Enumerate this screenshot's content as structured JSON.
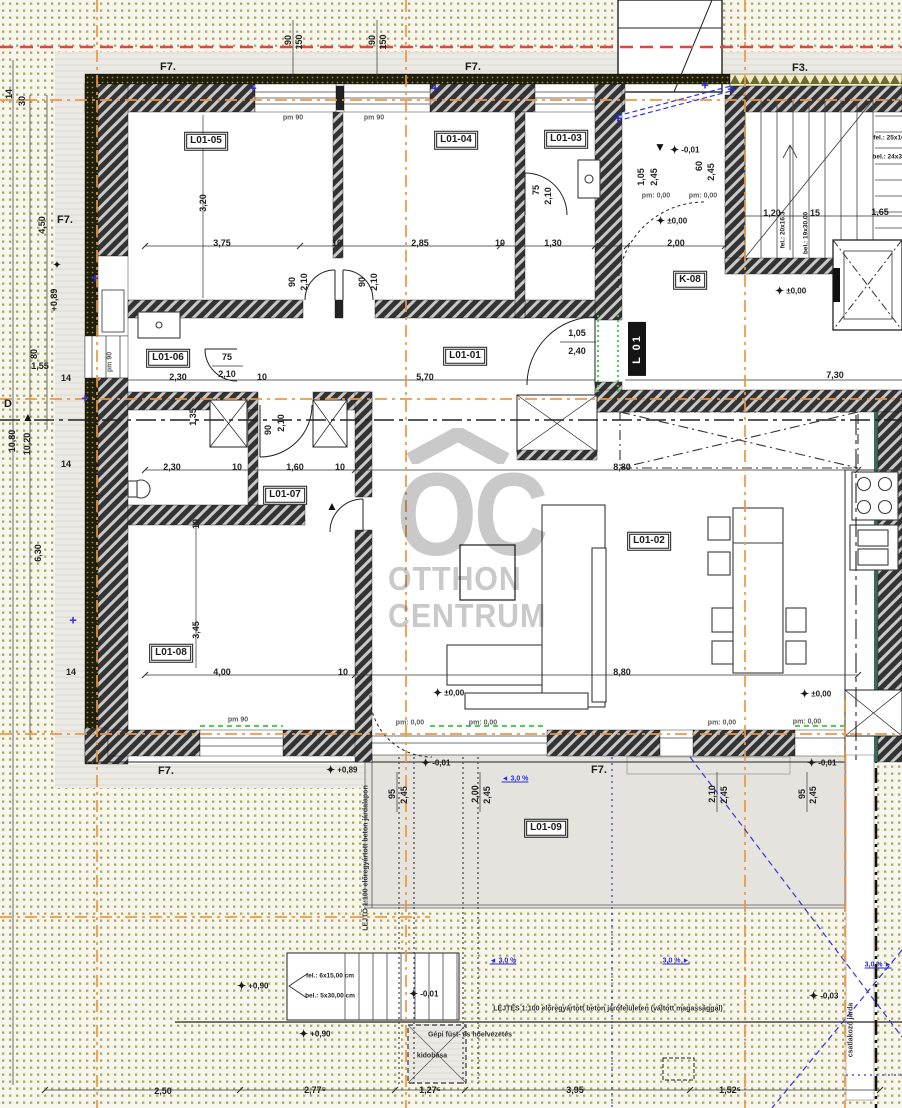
{
  "colors": {
    "paper": "#f8f6ec",
    "dot": "#a6a963",
    "apron": "#eae9e4",
    "terrace": "#e4e3de",
    "wall_dark": "#333333",
    "wall_stripe": "#c9c9c9",
    "insulation": "#1f1d0c",
    "accent_orange": "#f0953f",
    "accent_red": "#e04545",
    "accent_blue": "#3333e8",
    "accent_green": "#35cc35",
    "watermark": "#c6c6c6",
    "yellow_insulation": "#f0ebc4"
  },
  "watermark": {
    "logo": "OC",
    "line1": "OTTHON",
    "line2": "CENTRUM"
  },
  "texts": {
    "room_labels": [
      {
        "t": "L01-05",
        "x": 206,
        "y": 141
      },
      {
        "t": "L01-04",
        "x": 456,
        "y": 140
      },
      {
        "t": "L01-03",
        "x": 566,
        "y": 139
      },
      {
        "t": "L01-01",
        "x": 465,
        "y": 356
      },
      {
        "t": "L01-06",
        "x": 168,
        "y": 358
      },
      {
        "t": "L01-07",
        "x": 285,
        "y": 495
      },
      {
        "t": "L01-02",
        "x": 649,
        "y": 541
      },
      {
        "t": "L01-08",
        "x": 171,
        "y": 653
      },
      {
        "t": "L01-09",
        "x": 546,
        "y": 828
      },
      {
        "t": "K-08",
        "x": 690,
        "y": 280
      }
    ],
    "signs": [
      {
        "t": "L 01",
        "x": 637,
        "y": 349
      }
    ],
    "f_labels": [
      {
        "t": "F7.",
        "x": 168,
        "y": 67
      },
      {
        "t": "F7.",
        "x": 473,
        "y": 67
      },
      {
        "t": "F3.",
        "x": 800,
        "y": 68
      },
      {
        "t": "F7.",
        "x": 65,
        "y": 220
      },
      {
        "t": "F7.",
        "x": 166,
        "y": 771
      },
      {
        "t": "F7.",
        "x": 599,
        "y": 770
      },
      {
        "t": "D",
        "x": 8,
        "y": 404
      }
    ],
    "dims": [
      {
        "t": "3,75",
        "x": 222,
        "y": 243
      },
      {
        "t": "10",
        "x": 337,
        "y": 243
      },
      {
        "t": "2,85",
        "x": 420,
        "y": 243
      },
      {
        "t": "10",
        "x": 500,
        "y": 243
      },
      {
        "t": "1,30",
        "x": 553,
        "y": 243
      },
      {
        "t": "2,00",
        "x": 676,
        "y": 243
      },
      {
        "t": "2,30",
        "x": 178,
        "y": 377
      },
      {
        "t": "10",
        "x": 262,
        "y": 377
      },
      {
        "t": "5,70",
        "x": 425,
        "y": 377
      },
      {
        "t": "7,30",
        "x": 835,
        "y": 375
      },
      {
        "t": "75",
        "x": 227,
        "y": 357
      },
      {
        "t": "2,10",
        "x": 227,
        "y": 374
      },
      {
        "t": "2,30",
        "x": 172,
        "y": 467
      },
      {
        "t": "10",
        "x": 237,
        "y": 467
      },
      {
        "t": "1,60",
        "x": 295,
        "y": 467
      },
      {
        "t": "10",
        "x": 340,
        "y": 467
      },
      {
        "t": "8,80",
        "x": 622,
        "y": 467
      },
      {
        "t": "4,00",
        "x": 222,
        "y": 672
      },
      {
        "t": "10",
        "x": 343,
        "y": 672
      },
      {
        "t": "8,80",
        "x": 622,
        "y": 672
      },
      {
        "t": "1,20",
        "x": 772,
        "y": 213
      },
      {
        "t": "15",
        "x": 815,
        "y": 213
      },
      {
        "t": "1,65",
        "x": 880,
        "y": 212
      },
      {
        "t": "1,05",
        "x": 577,
        "y": 333
      },
      {
        "t": "2,40",
        "x": 577,
        "y": 351
      },
      {
        "t": "2,50",
        "x": 163,
        "y": 1091
      },
      {
        "t": "2,77⁵",
        "x": 315,
        "y": 1090
      },
      {
        "t": "1,27⁵",
        "x": 430,
        "y": 1090
      },
      {
        "t": "3,95",
        "x": 575,
        "y": 1090
      },
      {
        "t": "1,52⁵",
        "x": 730,
        "y": 1090
      },
      {
        "t": "1,55",
        "x": 40,
        "y": 366
      },
      {
        "t": "14",
        "x": 66,
        "y": 378
      },
      {
        "t": "14",
        "x": 66,
        "y": 464
      },
      {
        "t": "14",
        "x": 71,
        "y": 672
      },
      {
        "t": "3,20",
        "x": 203,
        "y": 203,
        "r": 1
      },
      {
        "t": "1,35",
        "x": 193,
        "y": 417,
        "r": 1
      },
      {
        "t": "3,45",
        "x": 196,
        "y": 630,
        "r": 1
      },
      {
        "t": "10",
        "x": 196,
        "y": 524,
        "r": 1
      },
      {
        "t": "90",
        "x": 292,
        "y": 282,
        "r": 1
      },
      {
        "t": "2,10",
        "x": 304,
        "y": 282,
        "r": 1
      },
      {
        "t": "90",
        "x": 362,
        "y": 282,
        "r": 1
      },
      {
        "t": "2,10",
        "x": 374,
        "y": 282,
        "r": 1
      },
      {
        "t": "75",
        "x": 536,
        "y": 190,
        "r": 1
      },
      {
        "t": "2,10",
        "x": 548,
        "y": 196,
        "r": 1
      },
      {
        "t": "90",
        "x": 268,
        "y": 430,
        "r": 1
      },
      {
        "t": "2,10",
        "x": 281,
        "y": 423,
        "r": 1
      },
      {
        "t": "1,05",
        "x": 641,
        "y": 177,
        "r": 1
      },
      {
        "t": "2,45",
        "x": 654,
        "y": 177,
        "r": 1
      },
      {
        "t": "60",
        "x": 699,
        "y": 166,
        "r": 1
      },
      {
        "t": "2,45",
        "x": 711,
        "y": 172,
        "r": 1
      },
      {
        "t": "95",
        "x": 392,
        "y": 794,
        "r": 1
      },
      {
        "t": "2,45",
        "x": 404,
        "y": 795,
        "r": 1
      },
      {
        "t": "2,00",
        "x": 475,
        "y": 794,
        "r": 1
      },
      {
        "t": "2,45",
        "x": 487,
        "y": 795,
        "r": 1
      },
      {
        "t": "2,10",
        "x": 712,
        "y": 794,
        "r": 1
      },
      {
        "t": "2,45",
        "x": 724,
        "y": 795,
        "r": 1
      },
      {
        "t": "95",
        "x": 802,
        "y": 794,
        "r": 1
      },
      {
        "t": "2,45",
        "x": 813,
        "y": 795,
        "r": 1
      },
      {
        "t": "4,50",
        "x": 42,
        "y": 225,
        "r": 1
      },
      {
        "t": "+0,89",
        "x": 54,
        "y": 300,
        "r": 1
      },
      {
        "t": "80",
        "x": 34,
        "y": 354,
        "r": 1
      },
      {
        "t": "10,80",
        "x": 12,
        "y": 441,
        "r": 1
      },
      {
        "t": "10,20",
        "x": 27,
        "y": 444,
        "r": 1
      },
      {
        "t": "6,30",
        "x": 38,
        "y": 553,
        "r": 1
      },
      {
        "t": "30",
        "x": 22,
        "y": 101,
        "r": 1
      },
      {
        "t": "14",
        "x": 9,
        "y": 94,
        "r": 1
      },
      {
        "t": "90",
        "x": 288,
        "y": 40,
        "r": 1
      },
      {
        "t": "150",
        "x": 299,
        "y": 42,
        "r": 1
      },
      {
        "t": "90",
        "x": 372,
        "y": 40,
        "r": 1
      },
      {
        "t": "150",
        "x": 383,
        "y": 42,
        "r": 1
      }
    ],
    "small": [
      {
        "t": "pm: 0,00",
        "x": 656,
        "y": 196
      },
      {
        "t": "pm: 0,00",
        "x": 703,
        "y": 196
      },
      {
        "t": "pm: 0,00",
        "x": 410,
        "y": 723
      },
      {
        "t": "pm: 0,00",
        "x": 483,
        "y": 723
      },
      {
        "t": "pm: 0,00",
        "x": 722,
        "y": 723
      },
      {
        "t": "pm: 0,00",
        "x": 807,
        "y": 722
      },
      {
        "t": "pm 90",
        "x": 293,
        "y": 118
      },
      {
        "t": "pm 90",
        "x": 374,
        "y": 118
      },
      {
        "t": "pm 90",
        "x": 238,
        "y": 720
      },
      {
        "t": "pm 90",
        "x": 110,
        "y": 362,
        "r": 1
      }
    ],
    "elevations": [
      {
        "t": "±0,00",
        "x": 656,
        "y": 221
      },
      {
        "t": "±0,00",
        "x": 775,
        "y": 291
      },
      {
        "t": "±0,00",
        "x": 433,
        "y": 693
      },
      {
        "t": "±0,00",
        "x": 800,
        "y": 694
      },
      {
        "t": "-0,01",
        "x": 670,
        "y": 150
      },
      {
        "t": "-0,01",
        "x": 421,
        "y": 763
      },
      {
        "t": "-0,01",
        "x": 807,
        "y": 763
      },
      {
        "t": "+0,89",
        "x": 326,
        "y": 770
      },
      {
        "t": "+0,90",
        "x": 237,
        "y": 986
      },
      {
        "t": "+0,90",
        "x": 299,
        "y": 1034
      },
      {
        "t": "-0,01",
        "x": 409,
        "y": 994
      },
      {
        "t": "-0,03",
        "x": 809,
        "y": 996
      }
    ],
    "stair_texts": [
      {
        "t": "fel.: 6x15,00 cm",
        "x": 330,
        "y": 976
      },
      {
        "t": "bel.: 5x30,00 cm",
        "x": 330,
        "y": 996
      },
      {
        "t": "fel.: 20x16,3",
        "x": 783,
        "y": 230,
        "r": 1
      },
      {
        "t": "bel.: 19x30,00",
        "x": 806,
        "y": 233,
        "r": 1
      },
      {
        "t": "fel.: 25x16",
        "x": 889,
        "y": 138
      },
      {
        "t": "bel.: 24x30",
        "x": 889,
        "y": 157
      }
    ],
    "notes": [
      {
        "t": "LEJTÉS 1:100 előregyártott beton járófelületen (váltott magassággal)",
        "x": 608,
        "y": 1009
      },
      {
        "t": "Gépi füst- és hőelvezetés",
        "x": 470,
        "y": 1035
      },
      {
        "t": "kidobása",
        "x": 432,
        "y": 1056
      },
      {
        "t": "LEJTŐ 1:100 előregyártott beton járdalapon",
        "x": 366,
        "y": 858,
        "r": 1
      },
      {
        "t": "csatlakozó járda",
        "x": 851,
        "y": 1030,
        "r": 1
      }
    ],
    "blue_slopes": [
      {
        "t": "3,0 %",
        "x": 515,
        "y": 779,
        "d": "left"
      },
      {
        "t": "3,0 %",
        "x": 503,
        "y": 961,
        "d": "left"
      },
      {
        "t": "3,0 %",
        "x": 676,
        "y": 961,
        "d": "right"
      },
      {
        "t": "3,0 %",
        "x": 878,
        "y": 965,
        "d": "right"
      }
    ]
  },
  "markers": {
    "stars": [
      [
        57,
        265
      ]
    ],
    "blue_plus": [
      [
        253,
        88
      ],
      [
        435,
        88
      ],
      [
        705,
        85
      ],
      [
        95,
        278
      ],
      [
        85,
        398
      ],
      [
        73,
        620
      ],
      [
        618,
        118
      ],
      [
        731,
        89
      ]
    ],
    "triangles": [
      {
        "t": "▼",
        "x": 660,
        "y": 147
      },
      {
        "t": "▲",
        "x": 28,
        "y": 417
      },
      {
        "t": "▲",
        "x": 332,
        "y": 506
      }
    ]
  }
}
